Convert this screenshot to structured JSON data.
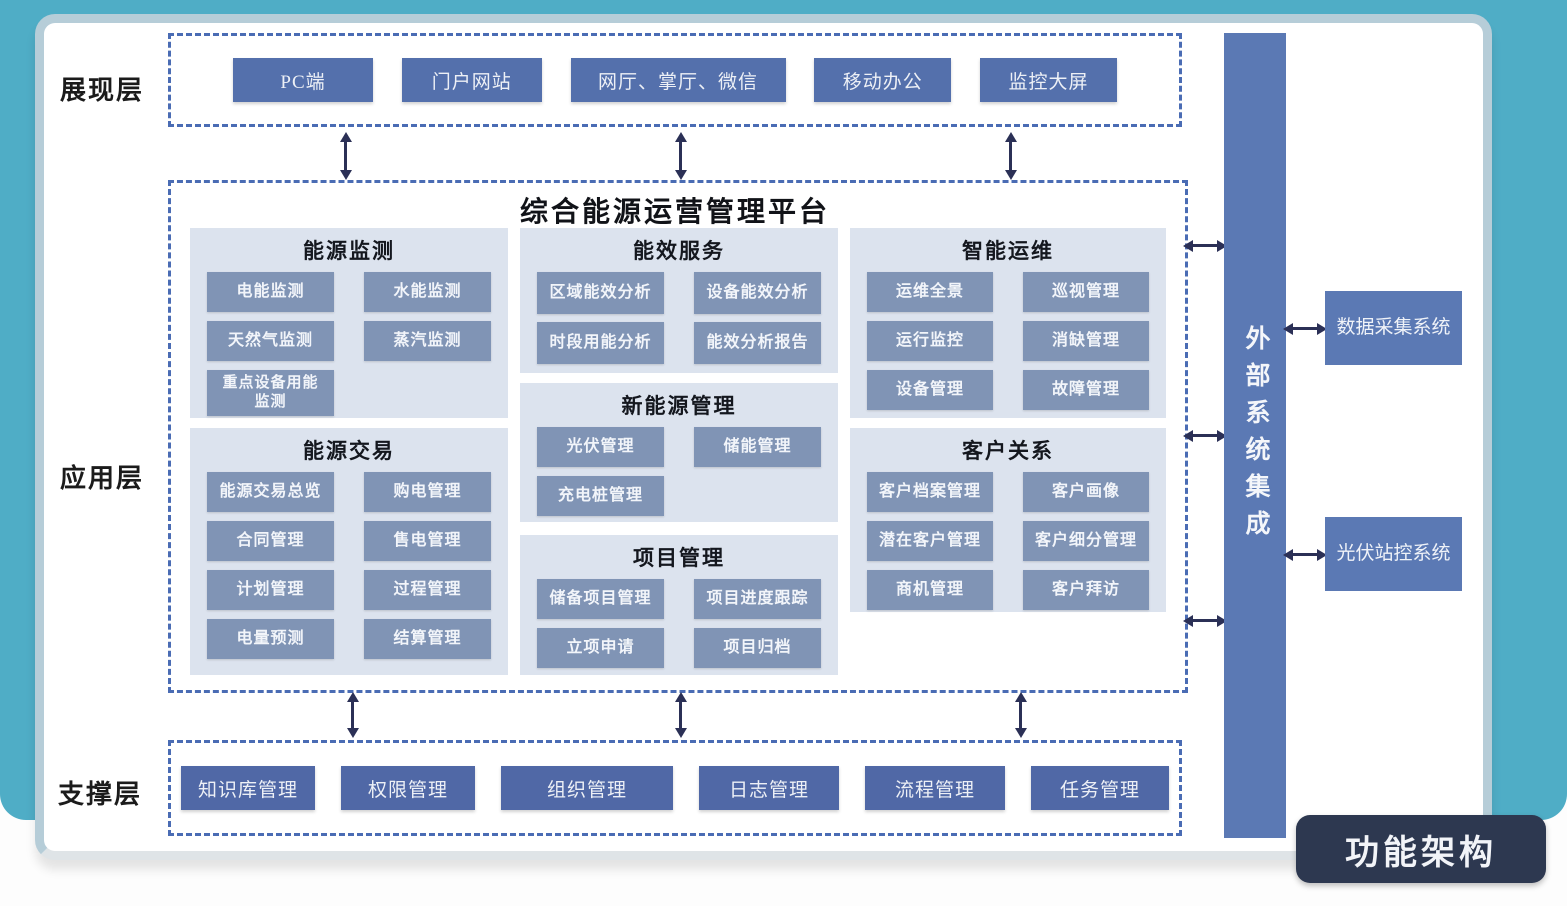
{
  "title": {
    "platform": "综合能源运营管理平台",
    "badge": "功能架构"
  },
  "layers": {
    "presentation": {
      "label": "展现层"
    },
    "application": {
      "label": "应用层"
    },
    "support": {
      "label": "支撑层"
    }
  },
  "presentation_items": [
    "PC端",
    "门户网站",
    "网厅、掌厅、微信",
    "移动办公",
    "监控大屏"
  ],
  "support_items": [
    "知识库管理",
    "权限管理",
    "组织管理",
    "日志管理",
    "流程管理",
    "任务管理"
  ],
  "sections": {
    "energy_monitoring": {
      "title": "能源监测",
      "items": [
        "电能监测",
        "水能监测",
        "天然气监测",
        "蒸汽监测",
        "重点设备用能监测"
      ]
    },
    "energy_trading": {
      "title": "能源交易",
      "items": [
        "能源交易总览",
        "购电管理",
        "合同管理",
        "售电管理",
        "计划管理",
        "过程管理",
        "电量预测",
        "结算管理"
      ]
    },
    "efficiency_service": {
      "title": "能效服务",
      "items": [
        "区域能效分析",
        "设备能效分析",
        "时段用能分析",
        "能效分析报告"
      ]
    },
    "new_energy": {
      "title": "新能源管理",
      "items": [
        "光伏管理",
        "储能管理",
        "充电桩管理"
      ]
    },
    "project_mgmt": {
      "title": "项目管理",
      "items": [
        "储备项目管理",
        "项目进度跟踪",
        "立项申请",
        "项目归档"
      ]
    },
    "intelligent_om": {
      "title": "智能运维",
      "items": [
        "运维全景",
        "巡视管理",
        "运行监控",
        "消缺管理",
        "设备管理",
        "故障管理"
      ]
    },
    "customer_relation": {
      "title": "客户关系",
      "items": [
        "客户档案管理",
        "客户画像",
        "潜在客户管理",
        "客户细分管理",
        "商机管理",
        "客户拜访"
      ]
    }
  },
  "external": {
    "bar": "外部系统集成",
    "systems": [
      "数据采集系统",
      "光伏站控系统"
    ]
  },
  "colors": {
    "teal_background": "#4FADC6",
    "dashed_border": "#4A6CB4",
    "primary_button": "#5470AC",
    "support_button": "#5068A6",
    "module_button": "#8094B5",
    "panel_background": "#DCE3EE",
    "external_bar": "#5B79B4",
    "badge_background": "#2D3850",
    "arrow": "#2B3056"
  }
}
